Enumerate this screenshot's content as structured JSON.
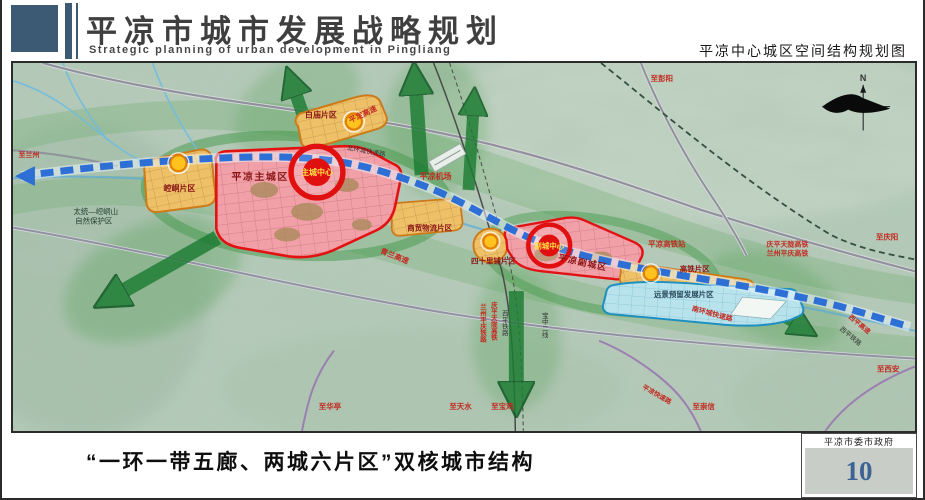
{
  "header": {
    "title_cn": "平凉市城市发展战略规划",
    "title_en": "Strategic planning of urban development in Pingliang",
    "map_title": "平凉中心城区空间结构规划图"
  },
  "footer": {
    "slogan": "“一环一带五廊、两城六片区”双核城市结构",
    "gov": "平凉市委市政府",
    "page_number": "10"
  },
  "map": {
    "colors": {
      "terrain": "#b4c9b8",
      "corridor_green": "#1d7c33",
      "axis_blue": "#2e6fd6",
      "zone_red": "#e21212",
      "zone_orange": "#cc7a1a",
      "zone_blue": "#1f8fc0",
      "center_yellow": "#ffc21e"
    },
    "labels": {
      "baimiao": "白庙片区",
      "kongtong": "崆峒片区",
      "main_city": "平凉主城区",
      "main_center": "主城中心",
      "trade": "商贸物流片区",
      "sishilipu": "四十里铺片区",
      "sub_city": "平凉副城区",
      "sub_center": "副城中心",
      "hsr_zone": "高铁片区",
      "future_zone": "远景预留发展片区",
      "airport": "平凉机场",
      "hsr_station": "平凉高铁站",
      "nature_reserve_l1": "太统—崆峒山",
      "nature_reserve_l2": "自然保护区",
      "pingding_expwy": "平定高速",
      "north_ring": "北环城快速路",
      "qinglan_expwy": "青兰高速",
      "south_ring": "南环城快速路",
      "pingliang_expwy": "平凉快速路",
      "xiping_expwy": "西平高速",
      "xiping_rail_diag": "西平铁路",
      "qptl_hsr": "庆平天陇高铁",
      "lzpq_hsr": "兰州平庆高铁",
      "rail_col_lzpq": "兰州平庆铁路",
      "rail_col_qptl": "庆平天陇高铁",
      "rail_col_xiping": "西平铁路",
      "rail_col_baozhong": "宝中二线",
      "to_pengyang": "至彭阳",
      "to_qingyang": "至庆阳",
      "to_xian": "至西安",
      "to_lanzhou": "至兰州",
      "to_huating": "至华亭",
      "to_tianshui": "至天水",
      "to_baoji": "至宝鸡",
      "to_chongxin": "至崇信",
      "compass_n": "N"
    }
  }
}
